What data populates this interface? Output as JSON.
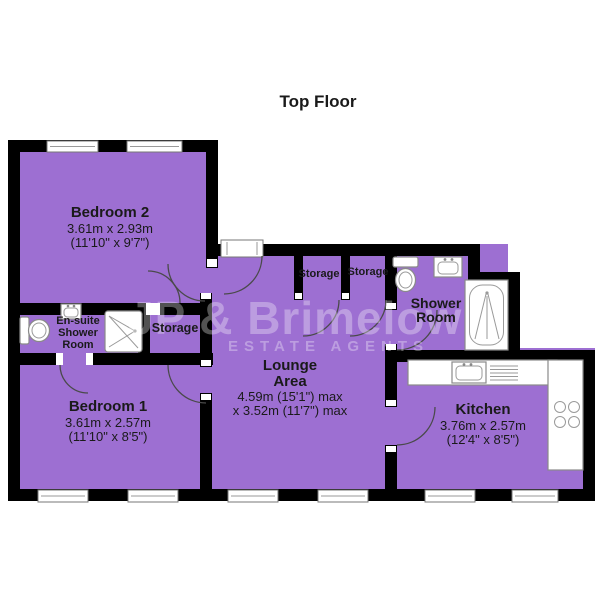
{
  "floor": {
    "title": "Top Floor"
  },
  "watermark": {
    "name": "JP & Brimelow",
    "tagline": "ESTATE AGENTS"
  },
  "rooms": {
    "bedroom2": {
      "name": "Bedroom 2",
      "metric": "3.61m x 2.93m",
      "imperial": "(11'10\" x 9'7\")"
    },
    "bedroom1": {
      "name": "Bedroom 1",
      "metric": "3.61m x 2.57m",
      "imperial": "(11'10\" x 8'5\")"
    },
    "lounge": {
      "name1": "Lounge",
      "name2": "Area",
      "metric": "4.59m (15'1\") max",
      "imperial": "x 3.52m (11'7\") max"
    },
    "kitchen": {
      "name": "Kitchen",
      "metric": "3.76m x 2.57m",
      "imperial": "(12'4\" x 8'5\")"
    },
    "ensuite": {
      "name1": "En-suite",
      "name2": "Shower",
      "name3": "Room"
    },
    "shower_room": {
      "name1": "Shower",
      "name2": "Room"
    },
    "storage_hall": {
      "name": "Storage"
    },
    "storage_closet_1": {
      "name": "Storage"
    },
    "storage_closet_2": {
      "name": "Storage"
    }
  },
  "colors": {
    "room_fill": "#9D6FD2",
    "wall": "#000000",
    "background": "#FFFFFF",
    "label_text": "#1A1A1A",
    "watermark": "rgba(255,255,255,0.32)"
  }
}
